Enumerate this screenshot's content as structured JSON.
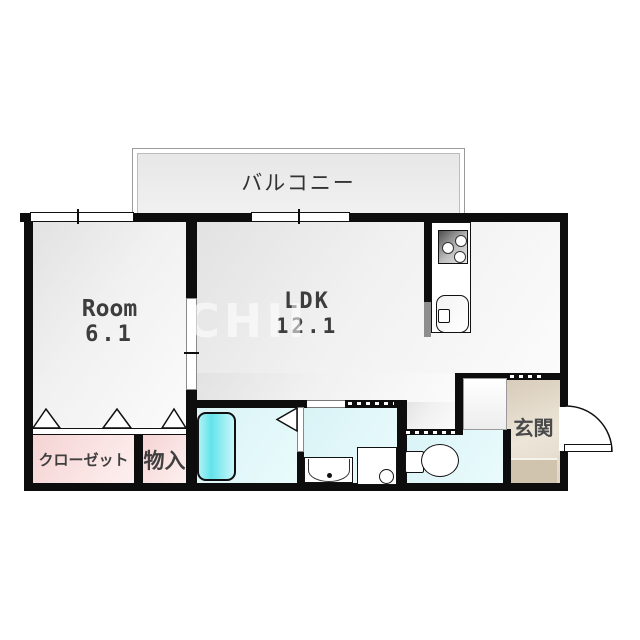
{
  "floorplan": {
    "balcony": {
      "label": "バルコニー"
    },
    "room": {
      "label": "Room",
      "area": "6.1"
    },
    "ldk": {
      "label": "LDK",
      "area": "12.1"
    },
    "closet": {
      "label": "クローゼット"
    },
    "storage": {
      "label": "物入"
    },
    "entrance": {
      "label": "玄関"
    },
    "watermark": {
      "text": "CHII"
    },
    "icons": [
      "stove-icon",
      "kitchen-sink-icon",
      "bathtub-icon",
      "bath-door-icon",
      "washbasin-icon",
      "washing-machine-icon",
      "toilet-icon",
      "entrance-door-arc-icon",
      "folding-door-icon",
      "window-icon"
    ],
    "colors": {
      "wall": "#0d0d0d",
      "room_floor": "#eeeeee",
      "closet_pink": "#f5d3d3",
      "wet_area_cyan": "#e2f6f8",
      "bathtub_cyan": "#62e3ea",
      "entrance_beige": "#d8ccba",
      "tataki_beige": "#d1c4ae",
      "balcony_gray": "#ebebeb"
    }
  }
}
